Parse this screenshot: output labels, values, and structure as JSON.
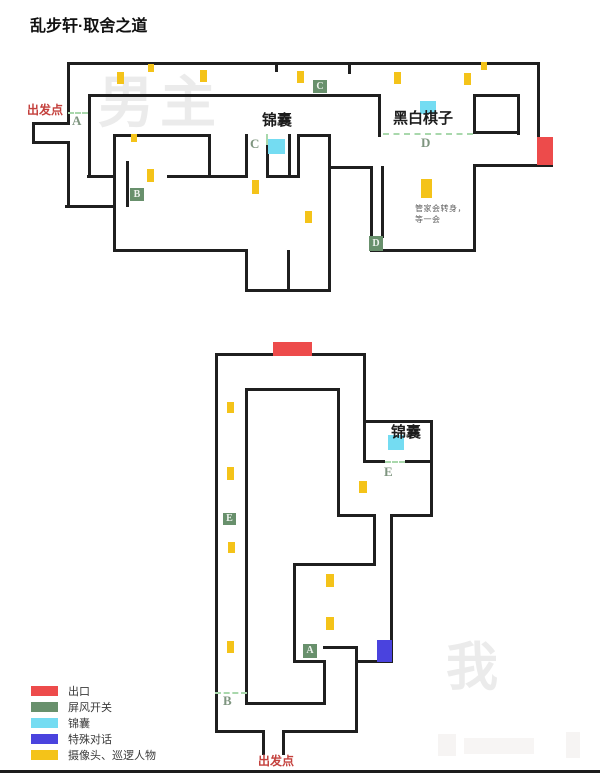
{
  "title": "乱步轩·取舍之道",
  "colors": {
    "wall": "#1f1f1f",
    "exit": "#ed4b4b",
    "screen": "#68906c",
    "bag": "#74dcf2",
    "dialog": "#4a43de",
    "patrol": "#f4c319",
    "dash": "#a9d8ac",
    "letter": "#7e957f",
    "red_text": "#c4413d",
    "watermark": "#ebebeb"
  },
  "legend": {
    "x": 31,
    "y": 683,
    "row_h": 16,
    "items": [
      {
        "key": "exit",
        "label": "出口"
      },
      {
        "key": "screen",
        "label": "屏风开关"
      },
      {
        "key": "bag",
        "label": "锦囊"
      },
      {
        "key": "dialog",
        "label": "特殊对话"
      },
      {
        "key": "patrol",
        "label": "摄像头、巡逻人物"
      }
    ]
  },
  "maps": [
    {
      "name": "upper-floor-map",
      "watermark": {
        "text": "男主",
        "x": 98,
        "y": 72,
        "size": 56
      },
      "walls": [
        [
          67,
          62,
          473,
          3
        ],
        [
          537,
          62,
          3,
          78
        ],
        [
          473,
          164,
          80,
          3
        ],
        [
          473,
          164,
          3,
          88
        ],
        [
          370,
          249,
          106,
          3
        ],
        [
          370,
          166,
          3,
          72
        ],
        [
          381,
          166,
          3,
          72
        ],
        [
          328,
          166,
          45,
          3
        ],
        [
          328,
          134,
          3,
          156
        ],
        [
          297,
          134,
          34,
          3
        ],
        [
          297,
          134,
          3,
          44
        ],
        [
          288,
          134,
          3,
          44
        ],
        [
          266,
          175,
          34,
          3
        ],
        [
          266,
          145,
          3,
          32
        ],
        [
          245,
          134,
          3,
          44
        ],
        [
          167,
          175,
          80,
          3
        ],
        [
          113,
          134,
          98,
          3
        ],
        [
          208,
          134,
          3,
          44
        ],
        [
          113,
          134,
          3,
          44
        ],
        [
          87,
          175,
          28,
          3
        ],
        [
          88,
          94,
          3,
          84
        ],
        [
          88,
          94,
          293,
          3
        ],
        [
          378,
          94,
          3,
          43
        ],
        [
          473,
          94,
          47,
          3
        ],
        [
          517,
          94,
          3,
          41
        ],
        [
          473,
          131,
          47,
          3
        ],
        [
          473,
          94,
          3,
          40
        ],
        [
          126,
          161,
          3,
          46
        ],
        [
          65,
          205,
          51,
          3
        ],
        [
          113,
          176,
          3,
          76
        ],
        [
          113,
          249,
          135,
          3
        ],
        [
          245,
          249,
          3,
          43
        ],
        [
          245,
          289,
          86,
          3
        ],
        [
          287,
          250,
          3,
          42
        ],
        [
          67,
          62,
          3,
          62
        ],
        [
          32,
          122,
          38,
          3
        ],
        [
          32,
          122,
          3,
          22
        ],
        [
          32,
          141,
          38,
          3
        ],
        [
          67,
          141,
          3,
          67
        ],
        [
          275,
          62,
          3,
          10
        ],
        [
          348,
          62,
          3,
          12
        ]
      ],
      "dashes": [
        {
          "dir": "h",
          "r": [
            68,
            112,
            20
          ]
        },
        {
          "dir": "h",
          "r": [
            383,
            133,
            90
          ]
        },
        {
          "dir": "v",
          "r": [
            266,
            134,
            11
          ]
        }
      ],
      "markers": [
        {
          "t": "exit",
          "r": [
            537,
            137,
            16,
            28
          ]
        },
        {
          "t": "screen",
          "r": [
            313,
            80,
            14,
            13
          ],
          "ch": "C"
        },
        {
          "t": "screen",
          "r": [
            130,
            188,
            14,
            13
          ],
          "ch": "B"
        },
        {
          "t": "screen",
          "r": [
            369,
            236,
            14,
            15
          ],
          "ch": "D"
        },
        {
          "t": "bag",
          "r": [
            268,
            139,
            17,
            15
          ]
        },
        {
          "t": "bag",
          "r": [
            420,
            101,
            16,
            13
          ]
        },
        {
          "t": "patrol",
          "r": [
            117,
            72,
            7,
            12
          ]
        },
        {
          "t": "patrol",
          "r": [
            148,
            64,
            6,
            8
          ]
        },
        {
          "t": "patrol",
          "r": [
            200,
            70,
            7,
            12
          ]
        },
        {
          "t": "patrol",
          "r": [
            297,
            71,
            7,
            12
          ]
        },
        {
          "t": "patrol",
          "r": [
            394,
            72,
            7,
            12
          ]
        },
        {
          "t": "patrol",
          "r": [
            481,
            62,
            6,
            8
          ]
        },
        {
          "t": "patrol",
          "r": [
            464,
            73,
            7,
            12
          ]
        },
        {
          "t": "patrol",
          "r": [
            131,
            134,
            6,
            8
          ]
        },
        {
          "t": "patrol",
          "r": [
            147,
            169,
            7,
            13
          ]
        },
        {
          "t": "patrol",
          "r": [
            252,
            180,
            7,
            14
          ]
        },
        {
          "t": "patrol",
          "r": [
            305,
            211,
            7,
            12
          ]
        },
        {
          "t": "patrol",
          "r": [
            421,
            179,
            11,
            19
          ]
        }
      ],
      "labels": [
        {
          "cls": "red",
          "text": "出发点",
          "x": 27,
          "y": 104
        },
        {
          "cls": "letter",
          "text": "A",
          "x": 72,
          "y": 114
        },
        {
          "cls": "bold-black",
          "text": "锦囊",
          "x": 262,
          "y": 113
        },
        {
          "cls": "letter",
          "text": "C",
          "x": 250,
          "y": 137
        },
        {
          "cls": "bold-black",
          "text": "黑白棋子",
          "x": 393,
          "y": 111
        },
        {
          "cls": "letter",
          "text": "D",
          "x": 421,
          "y": 136
        },
        {
          "cls": "note",
          "text": "管家会转身，",
          "x": 415,
          "y": 205
        },
        {
          "cls": "note",
          "text": "等一会",
          "x": 415,
          "y": 216
        }
      ]
    },
    {
      "name": "lower-floor-map",
      "watermark": {
        "text": "我",
        "x": 446,
        "y": 640,
        "size": 52
      },
      "walls": [
        [
          215,
          353,
          150,
          3
        ],
        [
          215,
          353,
          3,
          379
        ],
        [
          363,
          353,
          3,
          70
        ],
        [
          363,
          420,
          70,
          3
        ],
        [
          430,
          420,
          3,
          97
        ],
        [
          390,
          514,
          43,
          3
        ],
        [
          390,
          514,
          3,
          149
        ],
        [
          355,
          660,
          38,
          3
        ],
        [
          355,
          648,
          3,
          85
        ],
        [
          282,
          730,
          76,
          3
        ],
        [
          215,
          730,
          50,
          3
        ],
        [
          262,
          730,
          3,
          25
        ],
        [
          282,
          730,
          3,
          25
        ],
        [
          245,
          388,
          95,
          3
        ],
        [
          245,
          388,
          3,
          317
        ],
        [
          337,
          388,
          3,
          129
        ],
        [
          363,
          420,
          3,
          43
        ],
        [
          363,
          460,
          22,
          3
        ],
        [
          405,
          460,
          28,
          3
        ],
        [
          337,
          514,
          39,
          3
        ],
        [
          373,
          514,
          3,
          52
        ],
        [
          293,
          563,
          83,
          3
        ],
        [
          293,
          563,
          3,
          100
        ],
        [
          323,
          646,
          35,
          3
        ],
        [
          293,
          660,
          33,
          3
        ],
        [
          323,
          660,
          3,
          45
        ],
        [
          245,
          702,
          81,
          3
        ]
      ],
      "dashes": [
        {
          "dir": "h",
          "r": [
            385,
            461,
            20
          ]
        },
        {
          "dir": "h",
          "r": [
            215,
            692,
            32
          ]
        }
      ],
      "markers": [
        {
          "t": "exit",
          "r": [
            273,
            342,
            39,
            14
          ]
        },
        {
          "t": "bag",
          "r": [
            388,
            435,
            16,
            15
          ]
        },
        {
          "t": "screen",
          "r": [
            223,
            513,
            13,
            12
          ],
          "ch": "E"
        },
        {
          "t": "screen",
          "r": [
            303,
            644,
            14,
            14
          ],
          "ch": "A"
        },
        {
          "t": "dialog",
          "r": [
            377,
            640,
            15,
            22
          ]
        },
        {
          "t": "patrol",
          "r": [
            227,
            402,
            7,
            11
          ]
        },
        {
          "t": "patrol",
          "r": [
            227,
            467,
            7,
            13
          ]
        },
        {
          "t": "patrol",
          "r": [
            228,
            542,
            7,
            11
          ]
        },
        {
          "t": "patrol",
          "r": [
            359,
            481,
            8,
            12
          ]
        },
        {
          "t": "patrol",
          "r": [
            326,
            574,
            8,
            13
          ]
        },
        {
          "t": "patrol",
          "r": [
            326,
            617,
            8,
            13
          ]
        },
        {
          "t": "patrol",
          "r": [
            227,
            641,
            7,
            12
          ]
        }
      ],
      "labels": [
        {
          "cls": "bold-black",
          "text": "锦囊",
          "x": 391,
          "y": 425
        },
        {
          "cls": "letter",
          "text": "E",
          "x": 384,
          "y": 465
        },
        {
          "cls": "letter",
          "text": "B",
          "x": 223,
          "y": 694
        },
        {
          "cls": "red",
          "text": "出发点",
          "x": 258,
          "y": 755
        }
      ]
    }
  ]
}
